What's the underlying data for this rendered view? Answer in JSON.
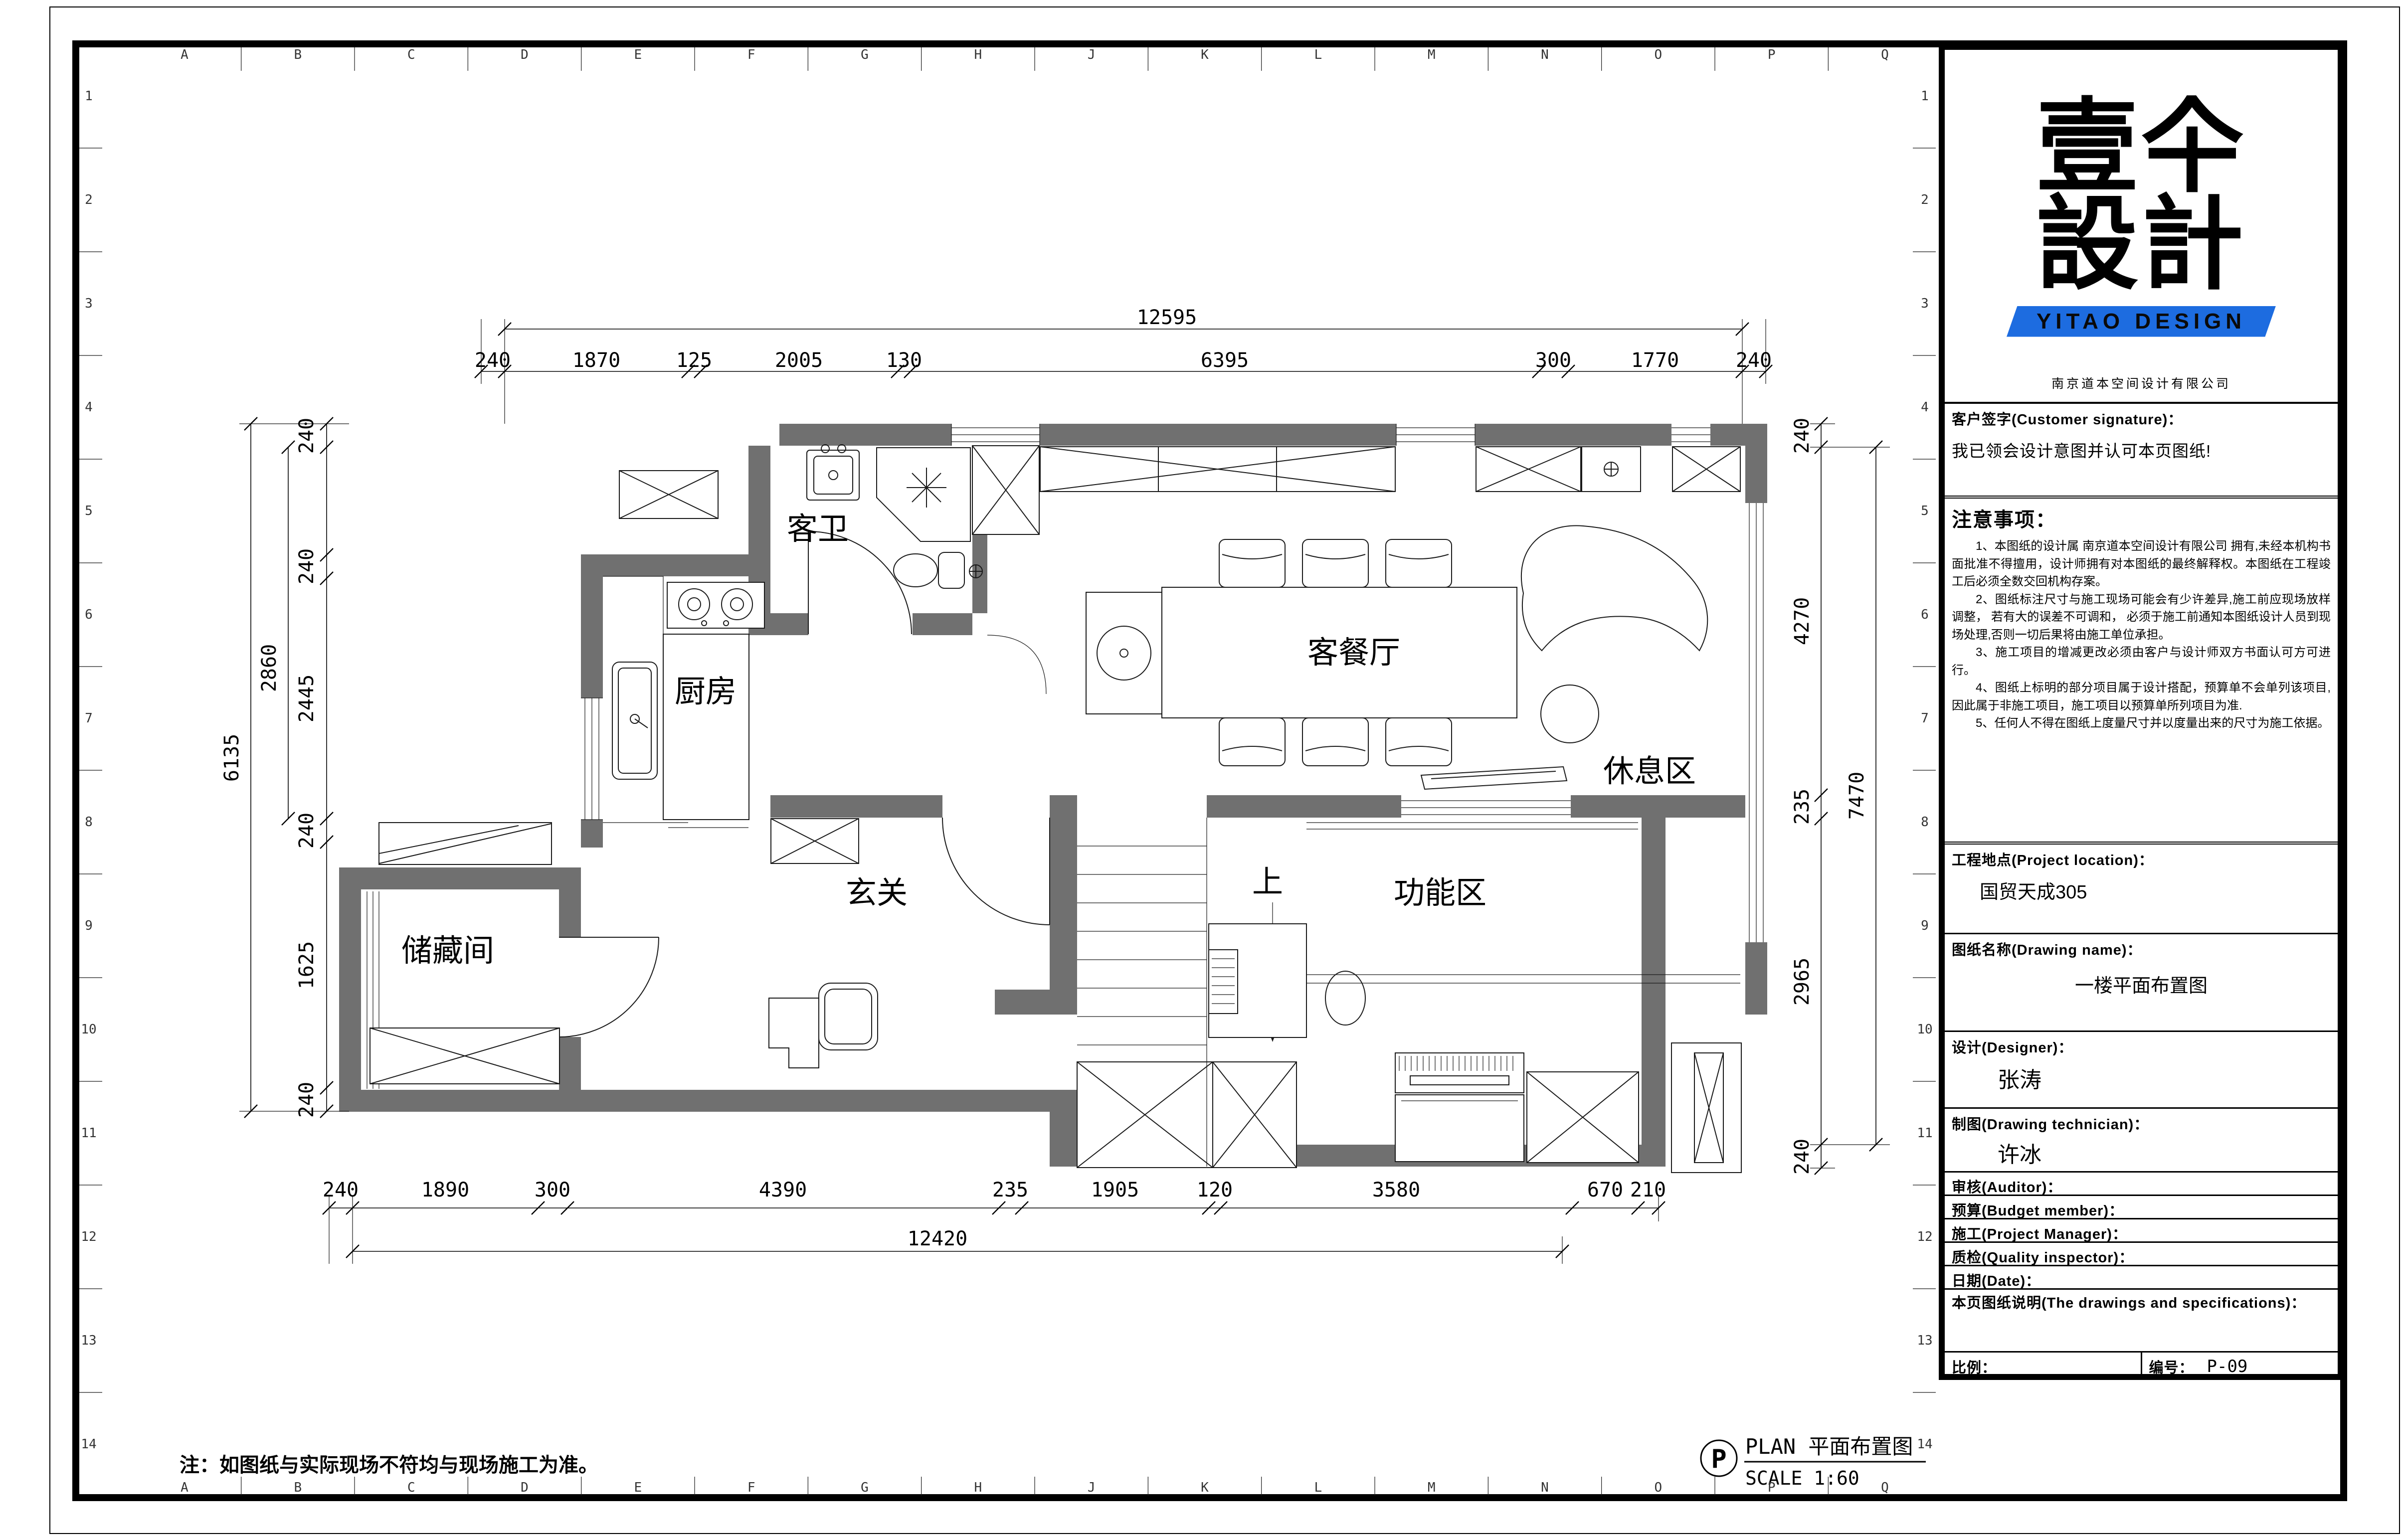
{
  "caption": {
    "symbol": "P",
    "title": "PLAN 平面布置图",
    "scale": "SCALE 1:60"
  },
  "note": "注：如图纸与实际现场不符均与现场施工为准。",
  "rooms": {
    "bath": "客卫",
    "kitchen": "厨房",
    "living": "客餐厅",
    "rest": "休息区",
    "storage": "储藏间",
    "entry": "玄关",
    "function": "功能区",
    "stair_up": "上"
  },
  "dims": {
    "top_overall": "12595",
    "top_chain": [
      "240",
      "1870",
      "125",
      "2005",
      "130",
      "6395",
      "300",
      "1770",
      "240"
    ],
    "bottom_overall": "12420",
    "bottom_chain": [
      "240",
      "1890",
      "300",
      "4390",
      "235",
      "1905",
      "120",
      "3580",
      "670",
      "210"
    ],
    "left_overall": "6135",
    "left_mid": "2860",
    "left_chain": [
      "240",
      "240",
      "2445",
      "240",
      "1625",
      "240"
    ],
    "right_overall": "7470",
    "right_chain": [
      "240",
      "4270",
      "235",
      "2965",
      "240"
    ]
  },
  "grid": {
    "letters": [
      "A",
      "B",
      "C",
      "D",
      "E",
      "F",
      "G",
      "H",
      "J",
      "K",
      "L",
      "M",
      "N",
      "O",
      "P",
      "Q"
    ],
    "numbers": [
      "1",
      "2",
      "3",
      "4",
      "5",
      "6",
      "7",
      "8",
      "9",
      "10",
      "11",
      "12",
      "13",
      "14"
    ]
  },
  "titleblock": {
    "logo": {
      "char1": "壹",
      "char2": "仐",
      "char3": "設",
      "char4": "計",
      "banner": "YITAO DESIGN",
      "company": "南京道本空间设计有限公司"
    },
    "signature": {
      "label": "客户签字(Customer signature)：",
      "body": "我已领会设计意图并认可本页图纸!"
    },
    "notes_title": "注意事项：",
    "notes": [
      "1、本图纸的设计属 南京道本空间设计有限公司 拥有,未经本机构书面批准不得擅用，设计师拥有对本图纸的最终解释权。本图纸在工程竣工后必须全数交回机构存案。",
      "2、图纸标注尺寸与施工现场可能会有少许差异,施工前应现场放样调整， 若有大的误差不可调和， 必须于施工前通知本图纸设计人员到现场处理,否则一切后果将由施工单位承担。",
      "3、施工项目的增减更改必须由客户与设计师双方书面认可方可进行。",
      "4、图纸上标明的部分项目属于设计搭配，预算单不会单列该项目,因此属于非施工项目，施工项目以预算单所列项目为准.",
      "5、任何人不得在图纸上度量尺寸并以度量出来的尺寸为施工依据。"
    ],
    "location": {
      "label": "工程地点(Project location)：",
      "value": "国贸天成305"
    },
    "drawing_name": {
      "label": "图纸名称(Drawing name)：",
      "value": "一楼平面布置图"
    },
    "designer": {
      "label": "设计(Designer)：",
      "value": "张涛"
    },
    "technician": {
      "label": "制图(Drawing technician)：",
      "value": "许冰"
    },
    "auditor_label": "审核(Auditor)：",
    "budget_label": "预算(Budget member)：",
    "pm_label": "施工(Project Manager)：",
    "qi_label": "质检(Quality inspector)：",
    "date_label": "日期(Date)：",
    "desc_label": "本页图纸说明(The drawings and specifications)：",
    "scale_label": "比例：",
    "serial_label": "编号：",
    "serial_value": "P-09"
  },
  "colors": {
    "wall": "#707070",
    "banner_blue": "#1d6ce0"
  }
}
